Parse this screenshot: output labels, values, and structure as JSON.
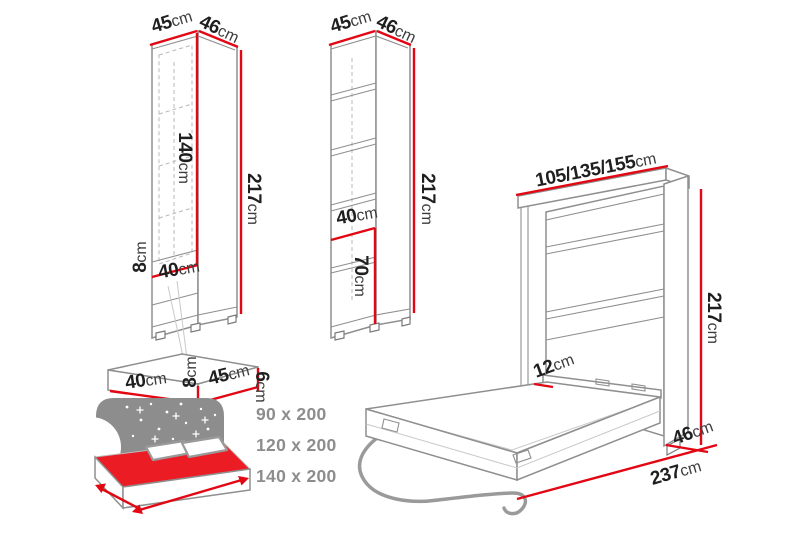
{
  "diagram_title": "wall-bed-furniture-dimension-diagram",
  "dimensions": {
    "cab_a_width": {
      "value": "45",
      "unit": "cm"
    },
    "cab_a_depth": {
      "value": "46",
      "unit": "cm"
    },
    "cab_a_inner_height": {
      "value": "140",
      "unit": "cm"
    },
    "cab_a_height": {
      "value": "217",
      "unit": "cm"
    },
    "cab_a_niche_height": {
      "value": "8",
      "unit": "cm"
    },
    "cab_a_niche_width": {
      "value": "40",
      "unit": "cm"
    },
    "cab_b_width": {
      "value": "45",
      "unit": "cm"
    },
    "cab_b_depth": {
      "value": "46",
      "unit": "cm"
    },
    "cab_b_height": {
      "value": "217",
      "unit": "cm"
    },
    "cab_b_niche_width": {
      "value": "40",
      "unit": "cm"
    },
    "cab_b_niche_height": {
      "value": "70",
      "unit": "cm"
    },
    "shelf_width": {
      "value": "40",
      "unit": "cm"
    },
    "shelf_height": {
      "value": "8",
      "unit": "cm"
    },
    "shelf_depth": {
      "value": "45",
      "unit": "cm"
    },
    "shelf_thickness": {
      "value": "6",
      "unit": "cm"
    },
    "bed_widths": {
      "value": "105/135/155",
      "unit": "cm"
    },
    "bed_height": {
      "value": "217",
      "unit": "cm"
    },
    "bed_frame_side": {
      "value": "12",
      "unit": "cm"
    },
    "bed_depth_closed": {
      "value": "46",
      "unit": "cm"
    },
    "bed_depth_open": {
      "value": "237",
      "unit": "cm"
    }
  },
  "mattress_sizes": [
    "90 x 200",
    "120 x 200",
    "140 x 200"
  ],
  "colors": {
    "background": "#ffffff",
    "dimension_line": "#e30613",
    "furniture_outline": "#8f8f8f",
    "label_text": "#1f1f1f",
    "unit_text": "#3d3d3d",
    "size_text": "#8d8d8d",
    "bed_mattress_red": "#ec1c24",
    "headboard_gray": "#8d8d8d"
  }
}
